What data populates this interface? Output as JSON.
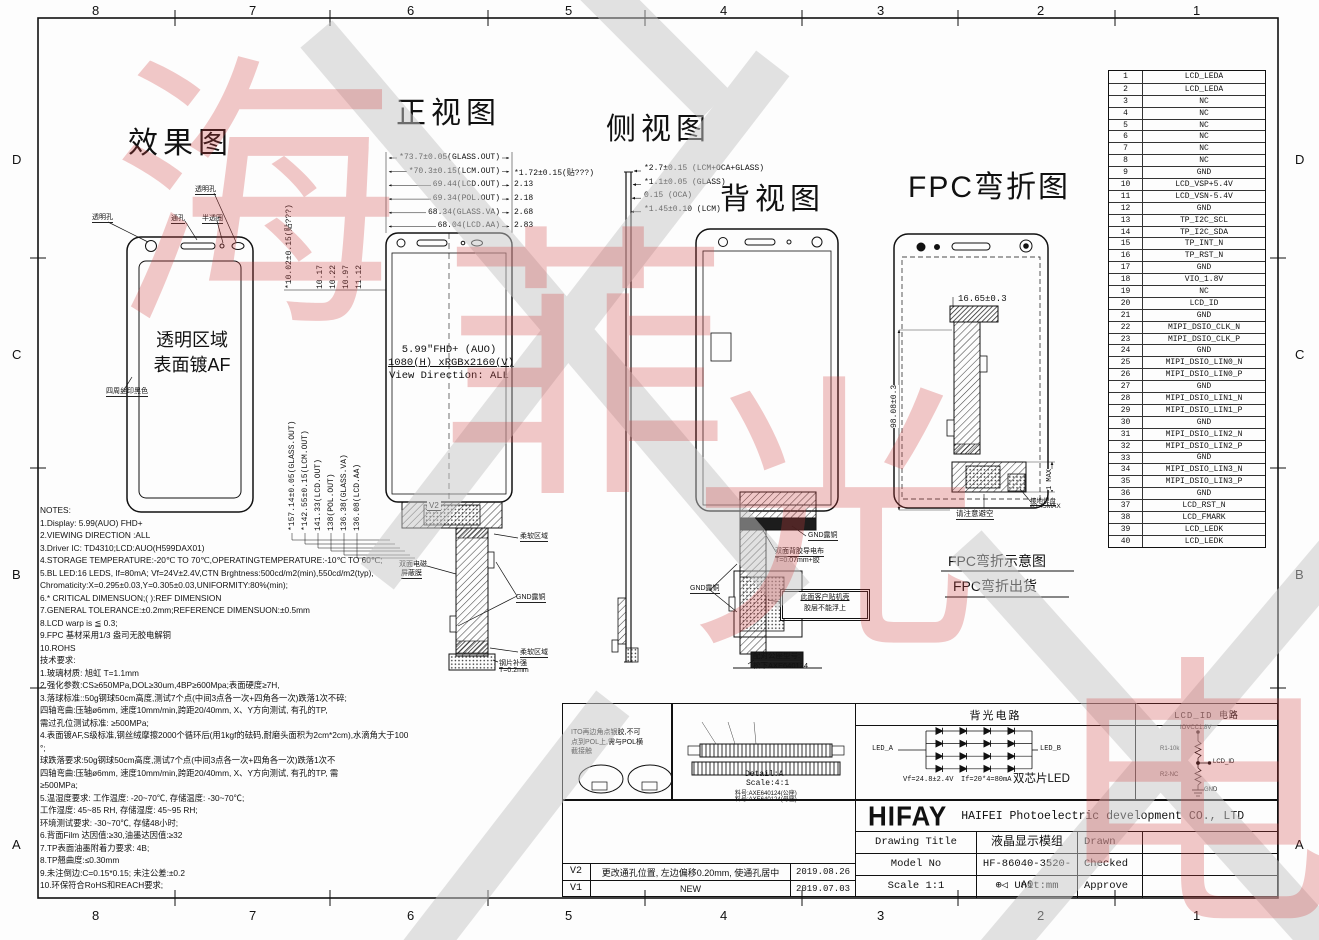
{
  "frame": {
    "cols": [
      "8",
      "7",
      "6",
      "5",
      "4",
      "3",
      "2",
      "1"
    ],
    "rows": [
      "D",
      "C",
      "B",
      "A"
    ]
  },
  "views": {
    "effect": {
      "title": "效果图",
      "labels": {
        "hole_left": "透明孔",
        "through": "通孔",
        "semi": "半透圈",
        "hole_top": "透明孔",
        "area1": "透明区域",
        "area2": "表面镀AF",
        "border": "四周丝印黑色"
      }
    },
    "front": {
      "title": "正视图",
      "rev_marker": "V2",
      "center": [
        "5.99\"FHD+ (AUO)",
        "1080(H) xRGBx2160(V)",
        "View Direction: ALL"
      ],
      "top_dims": [
        {
          "label": "*73.7±0.05(GLASS.OUT)",
          "right": ""
        },
        {
          "label": "*70.3±0.15(LCM.OUT)",
          "right": "*1.72±0.15(贴???)"
        },
        {
          "label": "69.44(LCD.OUT)",
          "right": "2.13"
        },
        {
          "label": "69.34(POL.OUT)",
          "right": "2.18"
        },
        {
          "label": "68.34(GLASS.VA)",
          "right": "2.68"
        },
        {
          "label": "68.04(LCD.AA)",
          "right": "2.83"
        }
      ],
      "left_dims_top": [
        "*10.02±0.15(贴???)",
        "10.17",
        "10.22",
        "10.97",
        "11.12"
      ],
      "left_dims": [
        "*157.14±0.05(GLASS.OUT)",
        "*142.55±0.15(LCM.OUT)",
        "141.33(LCD.OUT)",
        "138(POL.OUT)",
        "136.38(GLASS.VA)",
        "136.08(LCD.AA)"
      ],
      "fpc": {
        "soft_top": "柔软区域",
        "shield1": "双面电磁",
        "shield2": "屏蔽膜",
        "gnd": "GND露铜",
        "soft_bottom": "柔软区域",
        "stiff1": "钢片补强",
        "stiff2": "T=0.2mm"
      }
    },
    "side": {
      "title": "侧视图",
      "dims": [
        "*2.7±0.15 (LCM+OCA+GLASS)",
        "*1.1±0.05 (GLASS)",
        "0.15 (OCA)",
        "*1.45±0.10 (LCM)"
      ]
    },
    "back": {
      "title": "背视图",
      "labels": {
        "gnd_top": "GND露铜",
        "tape1": "双面背胶导电布",
        "tape2": "T=0.07mm+胶",
        "gnd_left": "GND露铜",
        "note1": "此面客户贴机壳",
        "note2": "胶层不能浮上",
        "conn1": "配对公座型号:",
        "conn2": "松下AXE640124"
      }
    },
    "fpc": {
      "title": "FPC弯折图",
      "dims": {
        "width": "16.65±0.3",
        "height": "98.08±0.3",
        "max": "1 MAX"
      },
      "labels": {
        "avoid": "请注意避空",
        "pad1": "接地焊盘",
        "pad2": "ø3.45MAX"
      },
      "caption1": "FPC弯折示意图",
      "caption2": "FPC弯折出货"
    }
  },
  "pin_table": {
    "rows": [
      {
        "num": "1",
        "name": "LCD_LEDA"
      },
      {
        "num": "2",
        "name": "LCD_LEDA"
      },
      {
        "num": "3",
        "name": "NC"
      },
      {
        "num": "4",
        "name": "NC"
      },
      {
        "num": "5",
        "name": "NC"
      },
      {
        "num": "6",
        "name": "NC"
      },
      {
        "num": "7",
        "name": "NC"
      },
      {
        "num": "8",
        "name": "NC"
      },
      {
        "num": "9",
        "name": "GND"
      },
      {
        "num": "10",
        "name": "LCD_VSP+5.4V"
      },
      {
        "num": "11",
        "name": "LCD_VSN-5.4V"
      },
      {
        "num": "12",
        "name": "GND"
      },
      {
        "num": "13",
        "name": "TP_I2C_SCL"
      },
      {
        "num": "14",
        "name": "TP_I2C_SDA"
      },
      {
        "num": "15",
        "name": "TP_INT_N"
      },
      {
        "num": "16",
        "name": "TP_RST_N"
      },
      {
        "num": "17",
        "name": "GND"
      },
      {
        "num": "18",
        "name": "VIO_1.8V"
      },
      {
        "num": "19",
        "name": "NC"
      },
      {
        "num": "20",
        "name": "LCD_ID"
      },
      {
        "num": "21",
        "name": "GND"
      },
      {
        "num": "22",
        "name": "MIPI_DSIO_CLK_N"
      },
      {
        "num": "23",
        "name": "MIPI_DSIO_CLK_P"
      },
      {
        "num": "24",
        "name": "GND"
      },
      {
        "num": "25",
        "name": "MIPI_DSIO_LIN0_N"
      },
      {
        "num": "26",
        "name": "MIPI_DSIO_LIN0_P"
      },
      {
        "num": "27",
        "name": "GND"
      },
      {
        "num": "28",
        "name": "MIPI_DSIO_LIN1_N"
      },
      {
        "num": "29",
        "name": "MIPI_DSIO_LIN1_P"
      },
      {
        "num": "30",
        "name": "GND"
      },
      {
        "num": "31",
        "name": "MIPI_DSIO_LIN2_N"
      },
      {
        "num": "32",
        "name": "MIPI_DSIO_LIN2_P"
      },
      {
        "num": "33",
        "name": "GND"
      },
      {
        "num": "34",
        "name": "MIPI_DSIO_LIN3_N"
      },
      {
        "num": "35",
        "name": "MIPI_DSIO_LIN3_P"
      },
      {
        "num": "36",
        "name": "GND"
      },
      {
        "num": "37",
        "name": "LCD_RST_N"
      },
      {
        "num": "38",
        "name": "LCD_FMARK"
      },
      {
        "num": "39",
        "name": "LCD_LEDK"
      },
      {
        "num": "40",
        "name": "LCD_LEDK"
      }
    ]
  },
  "notes": {
    "lines": [
      "NOTES:",
      "1.Display: 5.99(AUO) FHD+",
      "2.VIEWING DIRECTION :ALL",
      "3.Driver IC: TD4310;LCD:AUO(H599DAX01)",
      "4.STORAGE TEMPERATURE:-20℃ TO 70℃,OPERATINGTEMPERATURE:-10℃ TO 60℃;",
      "5.BL LED:16 LEDS, If=80mA; Vf=24V±2.4V,CTN Brghtness:500cd/m2(min),550cd/m2(typ),",
      "Chromaticity:X=0.295±0.03,Y=0.305±0.03,UNIFORMITY:80%(min);",
      "6.* CRITICAL DIMENSUON;( ):REF DIMENSION",
      "7.GENERAL TOLERANCE:±0.2mm;REFERENCE DIMENSUON:±0.5mm",
      "8.LCD warp is ≦ 0.3;",
      "9.FPC 基材采用1/3 盎司无胶电解铜",
      "10.ROHS",
      "技术要求:",
      "1.玻璃材质: 旭虹 T=1.1mm",
      "2.强化参数:CS≥650MPa,DOL≥30um,4BP≥600Mpa;表面硬度≥7H,",
      "3.落球标准::50g钢球50cm高度,测试7个点(中间3点各一次+四角各一次)跌落1次不碎;",
      "  四轴弯曲:压轴ø6mm, 速度10mm/min,跨距20/40mm, X、Y方向测试, 有孔的TP,",
      "       需过孔位测试标准: ≥500MPa;",
      "4.表面镀AF,S级标准,钢丝绒摩擦2000个循环后(用1kgf的砝码,耐磨头面积为2cm*2cm),水滴角大于100",
      "°;",
      "  球跌落要求:50g钢球50cm高度,测试7个点(中间3点各一次+四角各一次)跌落1次不",
      "  四轴弯曲:压轴ø6mm, 速度10mm/min,跨距20/40mm, X、Y方向测试, 有孔的TP, 需",
      "≥500MPa;",
      "5.温湿度要求: 工作温度: -20~70℃, 存储温度: -30~70℃;",
      "  工作湿度: 45~85 RH, 存储湿度: 45~95 RH;",
      "  环境测试要求: -30~70℃, 存储48小时;",
      "6.背面Film 达因值:≥30,油墨达因值:≥32",
      "7.TP表面油墨附着力要求: 4B;",
      "8.TP翘曲度:≤0.30mm",
      "9.未注倒边:C=0.15*0.15; 未注公差:±0.2",
      "10.环保符合RoHS和REACH要求;"
    ]
  },
  "bottom": {
    "ito_note": [
      "ITO再边角点银胶,不可",
      "点到POL上,需与POL横",
      "截接触"
    ],
    "detail": {
      "title": "Detail:A",
      "scale": "Scale:4:1",
      "part1": "料号:AXE640124(公座)",
      "part2": "料号:AXE640124(母座)"
    },
    "backlight": {
      "title": "背光电路",
      "led_a": "LED_A",
      "led_b": "LED_B",
      "spec1": "Vf=24.8±2.4V",
      "spec2": "If=20*4=80mA",
      "chip": "双芯片LED"
    },
    "lcdid": {
      "title": "LCD_ID 电路",
      "vio": "IOVCC1.8V",
      "r1": "R1-10k",
      "out": "LCD_ID",
      "r2": "R2-NC",
      "gnd": "GND"
    }
  },
  "revisions": [
    {
      "rev": "V2",
      "desc": "更改通孔位置, 左边偏移0.20mm, 使通孔居中",
      "date": "2019.08.26"
    },
    {
      "rev": "V1",
      "desc": "NEW",
      "date": "2019.07.03"
    }
  ],
  "titleblock": {
    "logo": "HIFAY",
    "company": "HAIFEI Photoelectric development CO., LTD",
    "rows": [
      {
        "label": "Drawing Title",
        "value": "液晶显示模组",
        "right": "Drawn"
      },
      {
        "label": "Model No",
        "value": "HF-86040-3520-A0",
        "right": "Checked"
      },
      {
        "label": "Scale 1:1",
        "value": "Unit:mm",
        "right": "Approve"
      }
    ],
    "unit_symbol": "⊕◁"
  },
  "watermark": {
    "chars": [
      "海",
      "菲",
      "光",
      "电"
    ],
    "red": "#d24040",
    "gray": "#c7c7c7"
  }
}
